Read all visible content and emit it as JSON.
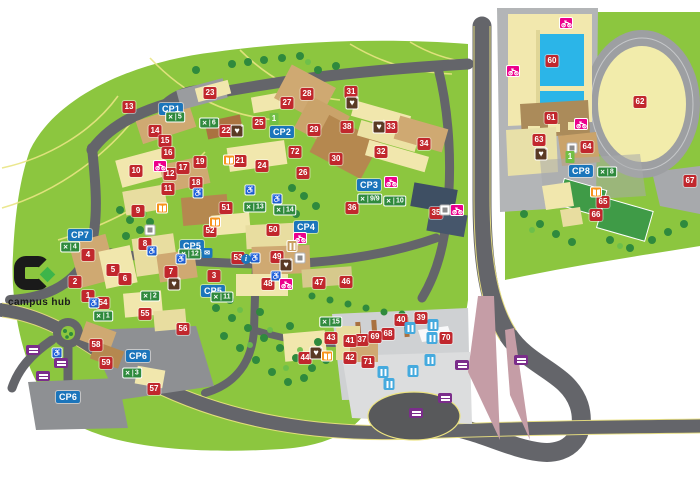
{
  "logo": {
    "text": "campus hub"
  },
  "map": {
    "accent_colors": {
      "building_marker": "#c1272d",
      "carpark_label": "#1b75bb",
      "crossing_badge": "#2f8a3d",
      "cycle_badge": "#ec008c",
      "defibrillator_badge": "#5a3a24",
      "library_badge": "#f7941d",
      "purple_badge": "#7b2d8b",
      "bus_stop_badge": "#45aade",
      "grass": "#8cc63f",
      "road": "#64656a"
    },
    "building_markers": [
      {
        "num": "1",
        "x": 88,
        "y": 296
      },
      {
        "num": "2",
        "x": 75,
        "y": 282
      },
      {
        "num": "3",
        "x": 214,
        "y": 276
      },
      {
        "num": "4",
        "x": 88,
        "y": 255
      },
      {
        "num": "5",
        "x": 113,
        "y": 270
      },
      {
        "num": "6",
        "x": 125,
        "y": 279
      },
      {
        "num": "7",
        "x": 171,
        "y": 272
      },
      {
        "num": "8",
        "x": 145,
        "y": 244
      },
      {
        "num": "9",
        "x": 138,
        "y": 211
      },
      {
        "num": "10",
        "x": 136,
        "y": 171
      },
      {
        "num": "11",
        "x": 168,
        "y": 189
      },
      {
        "num": "12",
        "x": 170,
        "y": 174
      },
      {
        "num": "13",
        "x": 129,
        "y": 107
      },
      {
        "num": "14",
        "x": 155,
        "y": 131
      },
      {
        "num": "15",
        "x": 165,
        "y": 141
      },
      {
        "num": "16",
        "x": 168,
        "y": 153
      },
      {
        "num": "17",
        "x": 183,
        "y": 168
      },
      {
        "num": "18",
        "x": 196,
        "y": 183
      },
      {
        "num": "19",
        "x": 200,
        "y": 162
      },
      {
        "num": "21",
        "x": 240,
        "y": 161
      },
      {
        "num": "22",
        "x": 226,
        "y": 131
      },
      {
        "num": "23",
        "x": 210,
        "y": 93
      },
      {
        "num": "24",
        "x": 262,
        "y": 166
      },
      {
        "num": "25",
        "x": 259,
        "y": 123
      },
      {
        "num": "26",
        "x": 303,
        "y": 173
      },
      {
        "num": "27",
        "x": 287,
        "y": 103
      },
      {
        "num": "28",
        "x": 307,
        "y": 94
      },
      {
        "num": "29",
        "x": 314,
        "y": 130
      },
      {
        "num": "30",
        "x": 336,
        "y": 159
      },
      {
        "num": "31",
        "x": 351,
        "y": 92
      },
      {
        "num": "32",
        "x": 381,
        "y": 152
      },
      {
        "num": "33",
        "x": 391,
        "y": 127
      },
      {
        "num": "34",
        "x": 424,
        "y": 144
      },
      {
        "num": "35",
        "x": 436,
        "y": 213
      },
      {
        "num": "36",
        "x": 352,
        "y": 208
      },
      {
        "num": "37",
        "x": 362,
        "y": 340
      },
      {
        "num": "38",
        "x": 347,
        "y": 127
      },
      {
        "num": "39",
        "x": 421,
        "y": 318
      },
      {
        "num": "40",
        "x": 401,
        "y": 320
      },
      {
        "num": "41",
        "x": 350,
        "y": 341
      },
      {
        "num": "42",
        "x": 350,
        "y": 358
      },
      {
        "num": "43",
        "x": 331,
        "y": 338
      },
      {
        "num": "44",
        "x": 305,
        "y": 358
      },
      {
        "num": "46",
        "x": 346,
        "y": 282
      },
      {
        "num": "47",
        "x": 319,
        "y": 283
      },
      {
        "num": "48",
        "x": 268,
        "y": 284
      },
      {
        "num": "49",
        "x": 277,
        "y": 257
      },
      {
        "num": "50",
        "x": 273,
        "y": 230
      },
      {
        "num": "51",
        "x": 226,
        "y": 208
      },
      {
        "num": "52",
        "x": 210,
        "y": 231
      },
      {
        "num": "53",
        "x": 238,
        "y": 258
      },
      {
        "num": "54",
        "x": 103,
        "y": 303
      },
      {
        "num": "55",
        "x": 145,
        "y": 314
      },
      {
        "num": "56",
        "x": 183,
        "y": 329
      },
      {
        "num": "57",
        "x": 154,
        "y": 389
      },
      {
        "num": "58",
        "x": 96,
        "y": 345
      },
      {
        "num": "59",
        "x": 106,
        "y": 363
      },
      {
        "num": "60",
        "x": 552,
        "y": 61
      },
      {
        "num": "61",
        "x": 551,
        "y": 118
      },
      {
        "num": "62",
        "x": 640,
        "y": 102
      },
      {
        "num": "63",
        "x": 539,
        "y": 140
      },
      {
        "num": "64",
        "x": 587,
        "y": 147
      },
      {
        "num": "65",
        "x": 603,
        "y": 202
      },
      {
        "num": "66",
        "x": 596,
        "y": 215
      },
      {
        "num": "67",
        "x": 690,
        "y": 181
      },
      {
        "num": "68",
        "x": 388,
        "y": 334
      },
      {
        "num": "69",
        "x": 375,
        "y": 337
      },
      {
        "num": "70",
        "x": 446,
        "y": 338
      },
      {
        "num": "71",
        "x": 368,
        "y": 362
      },
      {
        "num": "72",
        "x": 295,
        "y": 152
      }
    ],
    "cp_labels": [
      {
        "label": "CP1",
        "x": 171,
        "y": 109
      },
      {
        "label": "CP2",
        "x": 282,
        "y": 132
      },
      {
        "label": "CP3",
        "x": 369,
        "y": 185
      },
      {
        "label": "CP4",
        "x": 306,
        "y": 227
      },
      {
        "label": "CP5",
        "x": 192,
        "y": 246
      },
      {
        "label": "CP5",
        "x": 213,
        "y": 291
      },
      {
        "label": "CP6",
        "x": 138,
        "y": 356
      },
      {
        "label": "CP6",
        "x": 68,
        "y": 397
      },
      {
        "label": "CP7",
        "x": 80,
        "y": 235
      },
      {
        "label": "CP8",
        "x": 581,
        "y": 171
      }
    ],
    "crossing_badges": [
      {
        "num": "5",
        "x": 175,
        "y": 117
      },
      {
        "num": "6",
        "x": 209,
        "y": 123
      },
      {
        "num": "13",
        "x": 255,
        "y": 207
      },
      {
        "num": "14",
        "x": 285,
        "y": 210
      },
      {
        "num": "9/9",
        "x": 370,
        "y": 199
      },
      {
        "num": "10",
        "x": 395,
        "y": 201
      },
      {
        "num": "8",
        "x": 607,
        "y": 172
      },
      {
        "num": "12",
        "x": 190,
        "y": 254
      },
      {
        "num": "11",
        "x": 222,
        "y": 297
      },
      {
        "num": "2",
        "x": 150,
        "y": 296
      },
      {
        "num": "1",
        "x": 103,
        "y": 316
      },
      {
        "num": "3",
        "x": 132,
        "y": 373
      },
      {
        "num": "4",
        "x": 70,
        "y": 247
      },
      {
        "num": "15",
        "x": 331,
        "y": 322
      }
    ],
    "accessibility_badges": [
      {
        "x": 198,
        "y": 193
      },
      {
        "x": 250,
        "y": 190
      },
      {
        "x": 277,
        "y": 199
      },
      {
        "x": 255,
        "y": 258
      },
      {
        "x": 276,
        "y": 276
      },
      {
        "x": 94,
        "y": 303
      },
      {
        "x": 152,
        "y": 251
      },
      {
        "x": 181,
        "y": 259
      },
      {
        "x": 57,
        "y": 353
      }
    ],
    "defibrillator_badges": [
      {
        "x": 237,
        "y": 131
      },
      {
        "x": 352,
        "y": 103
      },
      {
        "x": 379,
        "y": 127
      },
      {
        "x": 541,
        "y": 154
      },
      {
        "x": 174,
        "y": 284
      },
      {
        "x": 286,
        "y": 265
      },
      {
        "x": 316,
        "y": 353
      }
    ],
    "library_badges": [
      {
        "x": 229,
        "y": 160
      },
      {
        "x": 162,
        "y": 208
      },
      {
        "x": 215,
        "y": 222
      },
      {
        "x": 596,
        "y": 192
      },
      {
        "x": 327,
        "y": 356
      }
    ],
    "cycle_badges": [
      {
        "x": 160,
        "y": 166
      },
      {
        "x": 566,
        "y": 23
      },
      {
        "x": 513,
        "y": 71
      },
      {
        "x": 581,
        "y": 124
      },
      {
        "x": 391,
        "y": 182
      },
      {
        "x": 457,
        "y": 210
      },
      {
        "x": 286,
        "y": 284
      },
      {
        "x": 300,
        "y": 238
      }
    ],
    "bus_stop_badges": [
      {
        "x": 410,
        "y": 328
      },
      {
        "x": 433,
        "y": 325
      },
      {
        "x": 432,
        "y": 338
      },
      {
        "x": 430,
        "y": 360
      },
      {
        "x": 383,
        "y": 372
      },
      {
        "x": 413,
        "y": 371
      },
      {
        "x": 389,
        "y": 384
      }
    ],
    "purple_badges": [
      {
        "x": 33,
        "y": 350
      },
      {
        "x": 61,
        "y": 363
      },
      {
        "x": 43,
        "y": 376
      },
      {
        "x": 462,
        "y": 365
      },
      {
        "x": 521,
        "y": 360
      },
      {
        "x": 445,
        "y": 398
      },
      {
        "x": 416,
        "y": 413
      }
    ],
    "info_badges": [
      {
        "label": "i",
        "x": 246,
        "y": 259
      }
    ],
    "post_badges": [
      {
        "x": 207,
        "y": 253
      }
    ],
    "misc_badges": [
      {
        "x": 150,
        "y": 230
      },
      {
        "x": 445,
        "y": 210
      },
      {
        "x": 300,
        "y": 258
      },
      {
        "x": 572,
        "y": 148
      }
    ],
    "tan_badges": [
      {
        "x": 292,
        "y": 246
      }
    ],
    "route_badges": [
      {
        "num": "1",
        "x": 274,
        "y": 119
      },
      {
        "num": "1",
        "x": 570,
        "y": 157
      }
    ]
  }
}
